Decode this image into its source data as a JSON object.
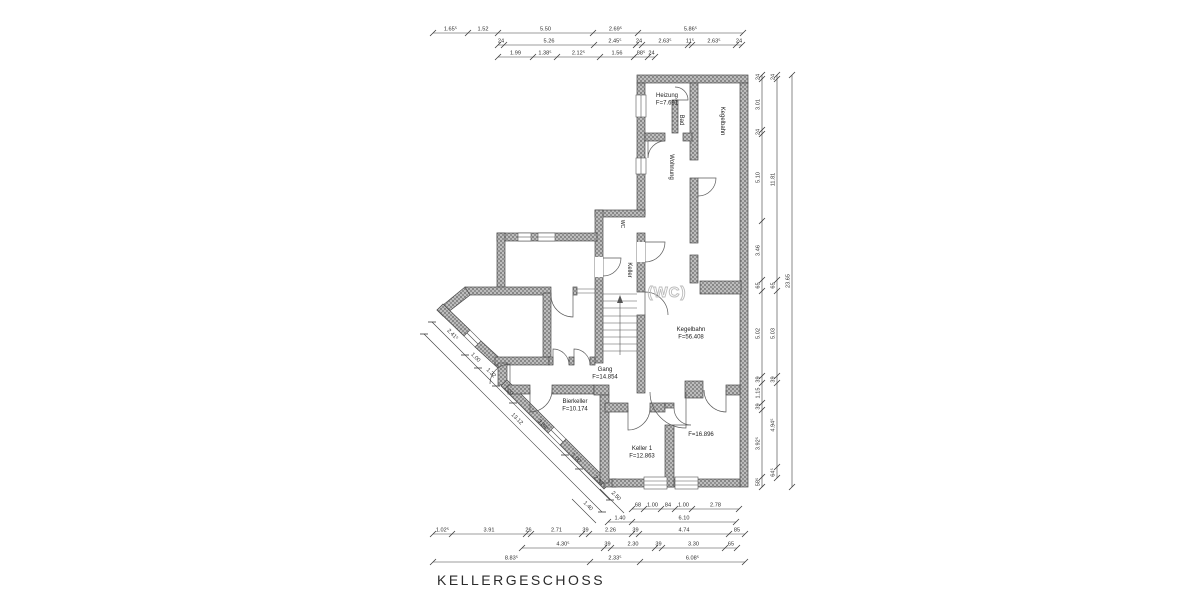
{
  "title": {
    "text": "KELLERGESCHOSS"
  },
  "rooms": [
    {
      "name": "heizung",
      "lines": [
        "Heizung",
        "F=7.691"
      ],
      "x": 667,
      "y": 97
    },
    {
      "name": "bad",
      "lines": [
        "Bad"
      ],
      "x": 680,
      "y": 120,
      "rot": 90
    },
    {
      "name": "wohnung",
      "lines": [
        "Wohnung"
      ],
      "x": 670,
      "y": 167,
      "rot": 90
    },
    {
      "name": "kegelbahn-corridor",
      "lines": [
        "Kegelbahn"
      ],
      "x": 721,
      "y": 121,
      "rot": 90
    },
    {
      "name": "wc-small",
      "lines": [
        "WC"
      ],
      "x": 621,
      "y": 224,
      "rot": 90,
      "fs": 5
    },
    {
      "name": "keller-corridor",
      "lines": [
        "Keller"
      ],
      "x": 628,
      "y": 270,
      "rot": 90
    },
    {
      "name": "wc-ghost",
      "lines": [
        "(WC)"
      ],
      "x": 667,
      "y": 297,
      "ghost": true
    },
    {
      "name": "kegelbahn-room",
      "lines": [
        "Kegelbahn",
        "F=56.408"
      ],
      "x": 691,
      "y": 331
    },
    {
      "name": "gang",
      "lines": [
        "Gang",
        "F=14.854"
      ],
      "x": 605,
      "y": 371
    },
    {
      "name": "bierkeller",
      "lines": [
        "Bierkeller",
        "F=10.174"
      ],
      "x": 575,
      "y": 403
    },
    {
      "name": "keller-1",
      "lines": [
        "Keller 1",
        "F=12.863"
      ],
      "x": 642,
      "y": 450
    },
    {
      "name": "keller-2",
      "lines": [
        "F=16.896"
      ],
      "x": 701,
      "y": 436
    }
  ],
  "dimensions": {
    "top_rows": [
      {
        "y": 33,
        "ticks": [
          433,
          468,
          498,
          593,
          638,
          743
        ],
        "labels": [
          "1.65⁵",
          "1.52",
          "5.50",
          "2.69⁵",
          "5.86⁵"
        ]
      },
      {
        "y": 45,
        "ticks": [
          498,
          504,
          594,
          636,
          642,
          688,
          692,
          736,
          742
        ],
        "labels": [
          "24",
          "5.26",
          "2.45⁵",
          "24",
          "2.63⁵",
          "11⁵",
          "2.63⁵",
          "24"
        ]
      },
      {
        "y": 57,
        "ticks": [
          498,
          533,
          557,
          600,
          634,
          648,
          655
        ],
        "labels": [
          "1.99",
          "1.38⁵",
          "2.12⁵",
          "1.56",
          "88⁵",
          "24"
        ]
      }
    ],
    "bottom_rows": [
      {
        "y": 509,
        "ticks": [
          632,
          644,
          661,
          675,
          692,
          739
        ],
        "labels": [
          "68",
          "1.00",
          "84",
          "1.00",
          "2.78"
        ]
      },
      {
        "y": 522,
        "ticks": [
          608,
          632,
          736
        ],
        "labels": [
          "1.40",
          "6.10"
        ]
      },
      {
        "y": 534,
        "ticks": [
          433,
          452,
          526,
          531,
          582,
          589,
          632,
          639,
          729,
          745
        ],
        "labels": [
          "1.02⁵",
          "3.91",
          "26",
          "2.71",
          "39",
          "2.26",
          "39",
          "4.74",
          "85"
        ]
      },
      {
        "y": 548,
        "ticks": [
          522,
          604,
          611,
          655,
          662,
          725,
          737
        ],
        "labels": [
          "4.30⁵",
          "39",
          "2.30",
          "39",
          "3.30",
          "65"
        ]
      },
      {
        "y": 562,
        "ticks": [
          433,
          590,
          640,
          745
        ],
        "labels": [
          "8.83⁵",
          "2.33⁵",
          "6.08⁵"
        ]
      }
    ],
    "right_cols": [
      {
        "x": 762,
        "ticks": [
          75,
          79,
          130,
          134,
          221,
          280,
          291,
          376,
          383,
          403,
          410,
          477,
          487
        ],
        "labels": [
          "24",
          "3.01",
          "24",
          "5.10",
          "3.46",
          "65",
          "5.02",
          "39",
          "1.15",
          "39",
          "3.92⁵",
          "58⁵"
        ]
      },
      {
        "x": 777,
        "ticks": [
          75,
          79,
          280,
          291,
          376,
          383,
          467,
          478
        ],
        "labels": [
          "24",
          "11.81",
          "65",
          "5.03",
          "39",
          "4.94⁵",
          "64⁵"
        ]
      },
      {
        "x": 792,
        "ticks": [
          75,
          487
        ],
        "labels": [
          "23.65"
        ]
      }
    ],
    "diagonal": {
      "start": [
        432,
        322
      ],
      "cum": [
        0,
        33,
        46,
        64,
        81,
        133,
        147,
        178
      ],
      "labels": [
        "2.41⁵",
        "1.00",
        "1.32",
        "1.20",
        "3.84⁵",
        "1.00",
        "2.33"
      ],
      "overall": {
        "start": [
          424,
          334
        ],
        "len": 178,
        "label": "13.12"
      },
      "extras": [
        {
          "x": 584,
          "y": 511,
          "label": "1.40"
        },
        {
          "x": 612,
          "y": 501,
          "label": "2.50"
        }
      ]
    }
  }
}
